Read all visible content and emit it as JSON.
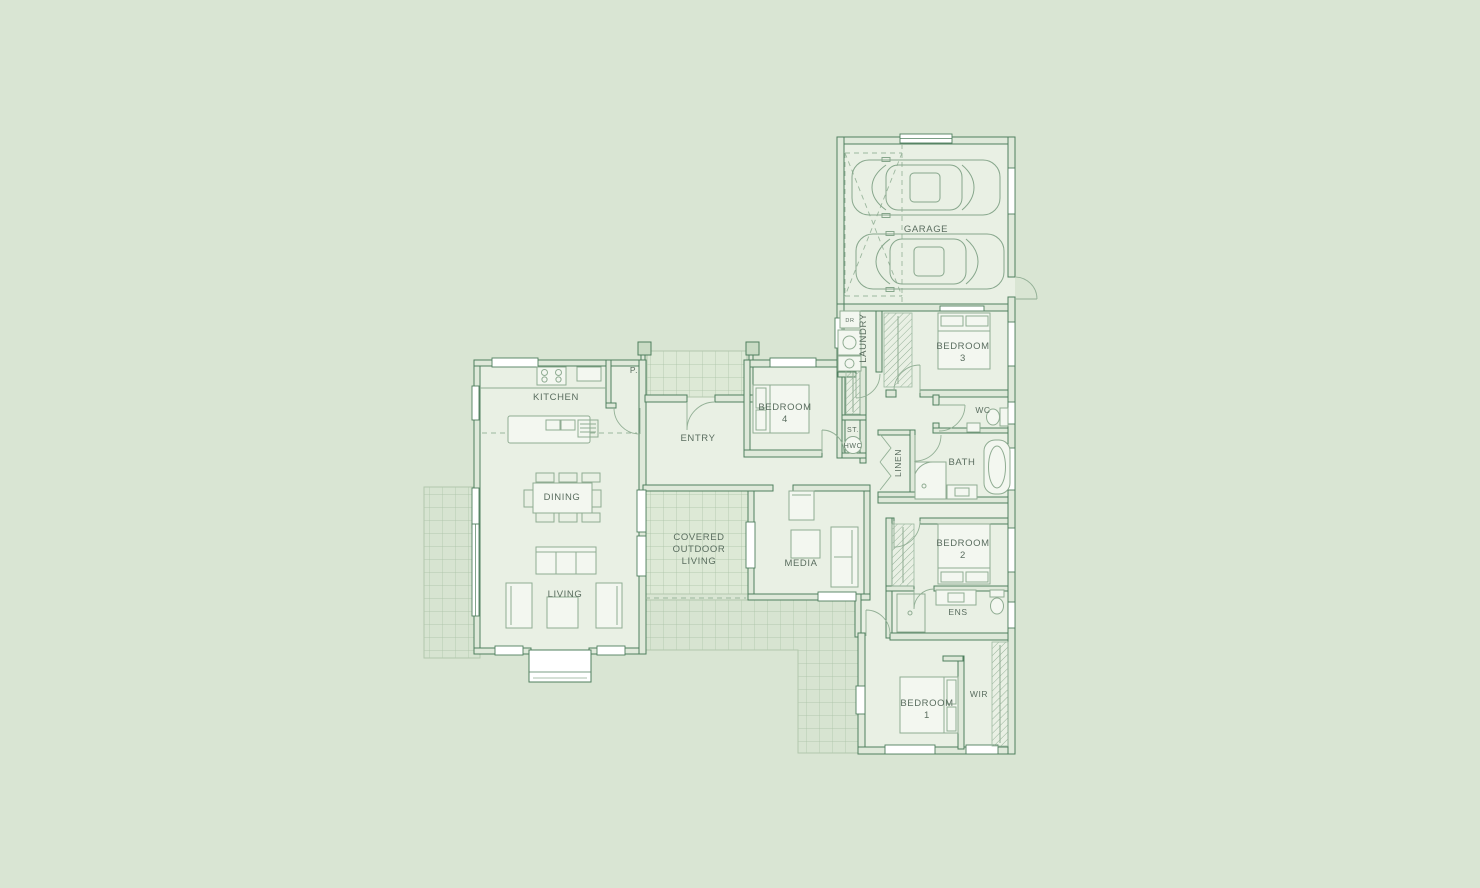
{
  "colors": {
    "background": "#d9e5d3",
    "wall_line": "#4f7f5e",
    "wall_fill": "#dfe9da",
    "room_fill": "#e9f0e4",
    "furniture_line": "#8fac92",
    "tile_line": "#a8c1a4",
    "window_fill": "#ffffff",
    "label_text": "#5a6d5f"
  },
  "labels": {
    "garage": "GARAGE",
    "laundry": "LAUNDRY",
    "dryer": "DR",
    "bedroom3": {
      "line1": "BEDROOM",
      "line2": "3"
    },
    "kitchen": "KITCHEN",
    "pantry": "P.",
    "entry": "ENTRY",
    "bedroom4": {
      "line1": "BEDROOM",
      "line2": "4"
    },
    "storage": "ST.",
    "hwc": "HWC",
    "wc": "WC",
    "bath": "BATH",
    "linen": "LINEN",
    "dining": "DINING",
    "living": "LIVING",
    "covered_outdoor_living": {
      "line1": "COVERED",
      "line2": "OUTDOOR",
      "line3": "LIVING"
    },
    "media": "MEDIA",
    "bedroom2": {
      "line1": "BEDROOM",
      "line2": "2"
    },
    "ens": "ENS",
    "bedroom1": {
      "line1": "BEDROOM",
      "line2": "1"
    },
    "wir": "WIR"
  }
}
